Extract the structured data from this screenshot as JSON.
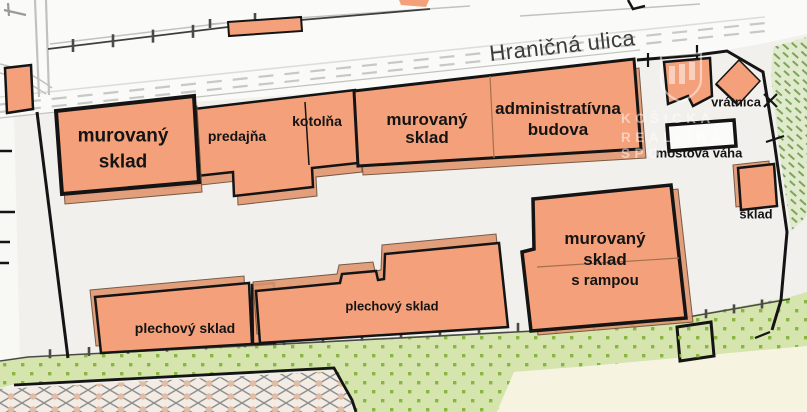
{
  "map": {
    "street_label": "Hraničná ulica",
    "buildings": {
      "sklad_left": {
        "l1": "murovaný",
        "l2": "sklad"
      },
      "predajna": {
        "label": "predajňa"
      },
      "kotolna": {
        "label": "kotolňa"
      },
      "sklad_mid": {
        "l1": "murovaný",
        "l2": "sklad"
      },
      "admin": {
        "l1": "administratívna",
        "l2": "budova"
      },
      "vratnica": {
        "label": "vrátnica"
      },
      "mostova_vaha": {
        "label": "mostová váha"
      },
      "sklad_small": {
        "label": "sklad"
      },
      "plechovy_1": {
        "label": "plechový sklad"
      },
      "plechovy_2": {
        "label": "plechový sklad"
      },
      "sklad_rampa": {
        "l1": "murovaný",
        "l2": "sklad",
        "l3": "s rampou"
      }
    },
    "watermark": {
      "l1": "KOŠICKÁ",
      "l2": "REALITNÁ",
      "l3": "SPO"
    },
    "colors": {
      "bg": "#F1F0ED",
      "white": "#FAFAF8",
      "bld": "#F4A17B",
      "bldsh": "#E29973",
      "outline": "#141414",
      "green": "#D5E5AD",
      "greendot": "#8AB545",
      "hatchbg": "#E0EACD",
      "hatch": "#7FA35B",
      "cream": "#F6F4E0",
      "crossbg": "#F2ECE5",
      "cross": "#8F8F8F",
      "crossdot": "#E2BCA4",
      "dash": "#C8C8C4",
      "fence": "#4A4A48",
      "label": "#141414",
      "street": "#3C3C3C"
    }
  }
}
